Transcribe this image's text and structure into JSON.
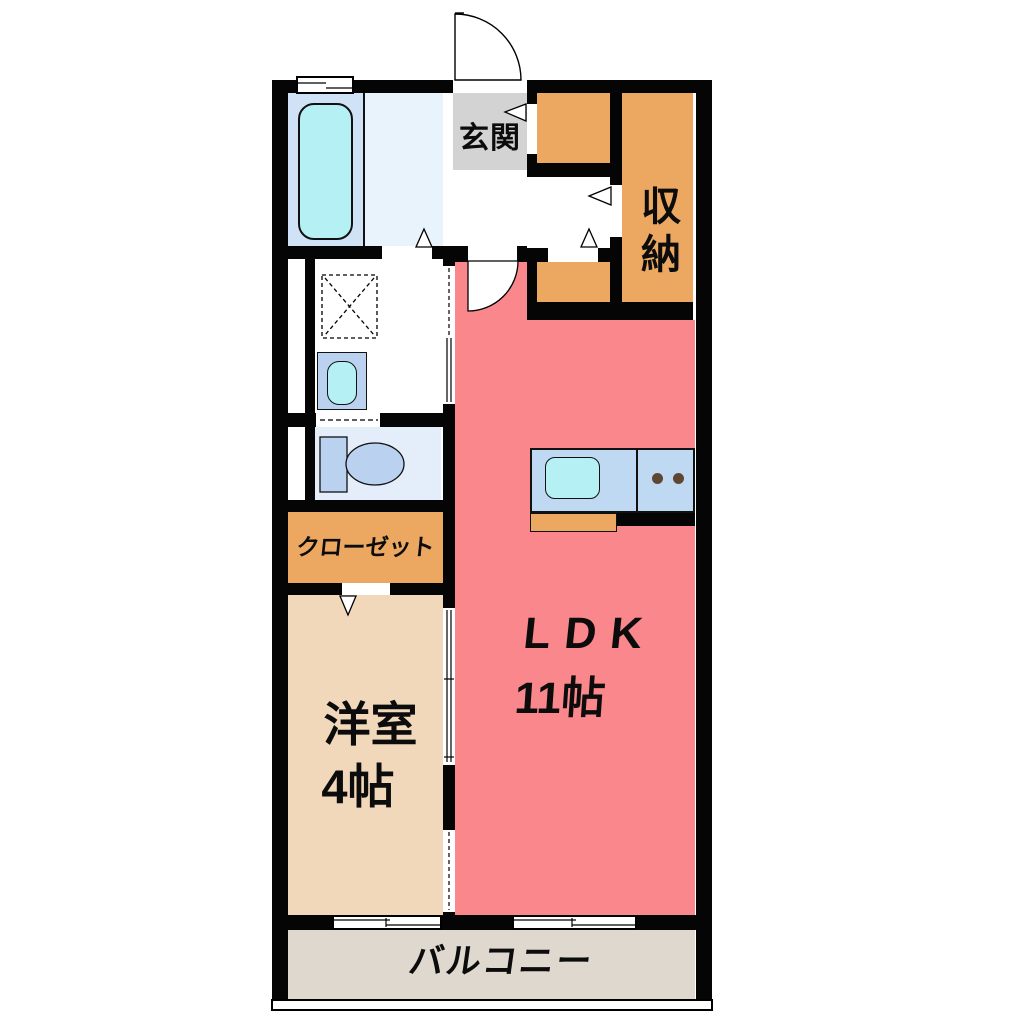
{
  "plan": {
    "type": "floorplan",
    "labels": {
      "entrance": "玄関",
      "storage": "収納",
      "closet": "クローゼット",
      "western_room": "洋室",
      "western_room_size": "4帖",
      "ldk": "LDK",
      "ldk_size": "11帖",
      "balcony": "バルコニー"
    },
    "colors": {
      "wall": "#050505",
      "ldk_pink": "#f9878b",
      "storage_orange": "#eca861",
      "western_beige": "#f1d8ba",
      "balcony_gray": "#ded8cf",
      "entrance_gray": "#d3d3d3",
      "bath_blue": "#cfe2f6",
      "bath_light": "#e8f3fc",
      "water_cyan": "#b5f0f4",
      "fixture_blue": "#bad2f0",
      "toilet_floor": "#e3eefa",
      "kitchen_counter": "#c0d9f2",
      "burner_brown": "#5f4632"
    }
  }
}
